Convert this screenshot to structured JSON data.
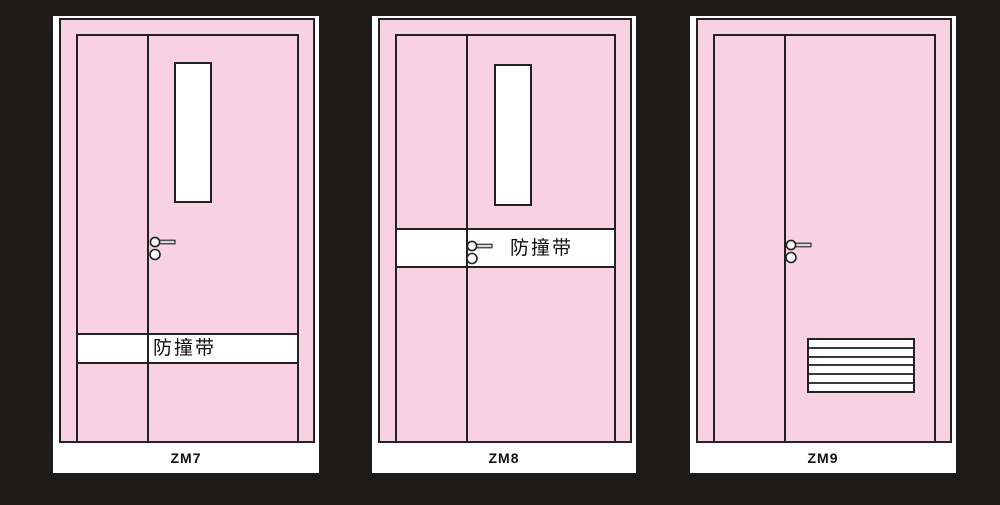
{
  "page": {
    "background_color": "#1d1a1a",
    "description": "Three steel door elevation drawings on dark background"
  },
  "colors": {
    "door_fill": "#f8d2e2",
    "outline": "#222222",
    "card_background": "#ffffff",
    "strip_fill": "#ffffff",
    "handle_fill": "#d8d8d8"
  },
  "doors": [
    {
      "id": "ZM7",
      "label": "ZM7",
      "impact_strip_label": "防撞带",
      "features": [
        "unequal-double-leaf",
        "vision-window",
        "lever-handle",
        "impact-strip-low"
      ]
    },
    {
      "id": "ZM8",
      "label": "ZM8",
      "impact_strip_label": "防撞带",
      "features": [
        "unequal-double-leaf",
        "vision-window",
        "lever-handle",
        "impact-strip-at-handle"
      ]
    },
    {
      "id": "ZM9",
      "label": "ZM9",
      "features": [
        "unequal-double-leaf",
        "lever-handle",
        "louver-vent"
      ]
    }
  ]
}
